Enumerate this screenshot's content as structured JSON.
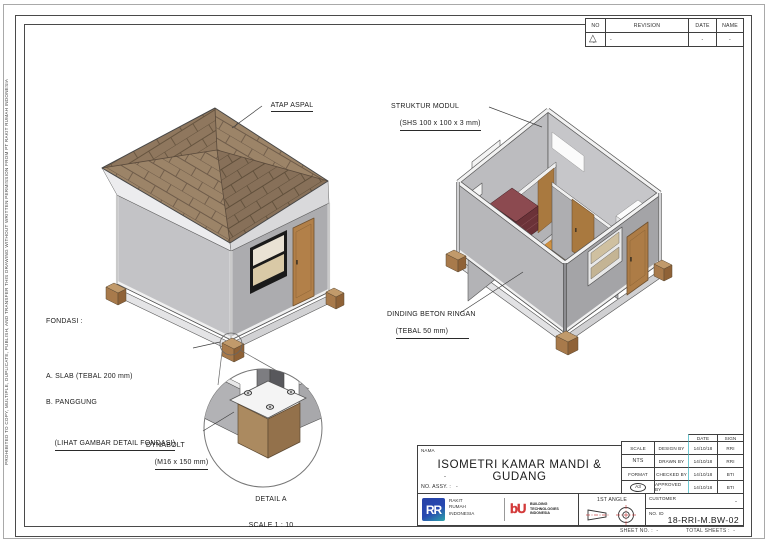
{
  "page": {
    "side_note": "PROHIBITED TO COPY, MULTIPLE, DUPLICATE, PUBLISH, AND TRANSFER THIS DRAWING WITHOUT WRITTEN PERMISSION FROM PT RAKIT RUMAH INDONESIA",
    "footer": {
      "sheet_no_label": "SHEET NO. :",
      "sheet_no_value": "-",
      "total_sheets_label": "TOTAL SHEETS :",
      "total_sheets_value": "-"
    }
  },
  "revision_table": {
    "headers": {
      "no": "NO",
      "revision": "REVISION",
      "date": "DATE",
      "name": "NAME"
    },
    "row": {
      "no": "-",
      "revision": "-",
      "date": "-",
      "name": "-"
    }
  },
  "annotations": {
    "atap": "ATAP ASPAL",
    "struktur_line1": "STRUKTUR MODUL",
    "struktur_line2": "(SHS 100 x 100 x 3 mm)",
    "fondasi_title": "FONDASI :",
    "fondasi_a": "A. SLAB (TEBAL 200 mm)",
    "fondasi_b": "B. PANGGUNG",
    "fondasi_note": "(LIHAT GAMBAR DETAIL FONDASI)",
    "dinding_line1": "DINDING BETON RINGAN",
    "dinding_line2": "(TEBAL 50 mm)",
    "dynabolt_line1": "DYNABOLT",
    "dynabolt_line2": "(M16 x 150 mm)",
    "detail_title": "DETAIL A",
    "detail_scale": "SCALE 1 : 10"
  },
  "title_block": {
    "nama_label": "NAMA",
    "title": "ISOMETRI KAMAR MANDI & GUDANG",
    "subtitle": "-",
    "no_assy_label": "NO. ASSY. :",
    "no_assy_value": "-",
    "scale_label": "SCALE",
    "scale_value": "NTS",
    "format_label": "FORMAT",
    "format_value": "A3",
    "date_header": "DATE",
    "sign_header": "SIGN",
    "sign_rows": [
      {
        "label": "DESIGN BY",
        "date": "14/10/18",
        "sign": "RRI"
      },
      {
        "label": "DRAWN BY",
        "date": "14/10/18",
        "sign": "RRI"
      },
      {
        "label": "CHECKED BY",
        "date": "14/10/18",
        "sign": "BTI"
      },
      {
        "label": "APPROVED BY",
        "date": "14/10/18",
        "sign": "BTI"
      }
    ],
    "logo_rri_text": "RR",
    "company1_lines": [
      "RAKIT",
      "RUMAH",
      "INDONESIA"
    ],
    "logo_bti_text": "bU",
    "company2_lines": [
      "BUILDING",
      "TECHNOLOGIES",
      "INDONESIA"
    ],
    "angle_label": "1ST ANGLE",
    "customer_label": "CUSTOMER",
    "customer_value": "-",
    "no_id_label": "NO. ID",
    "no_id_value": "18-RRI-M.BW-02"
  },
  "colors": {
    "roof_shingle": "#9c8468",
    "roof_line": "#6e5b49",
    "wall_light": "#c3c3c6",
    "wall_dark": "#a6a6a9",
    "door_wood": "#b28049",
    "floor_wood": "#d0913f",
    "brick_maroon": "#6b3238",
    "foundation_block": "#a87a4b",
    "logo_blue": "#2742a6",
    "logo_teal": "#2da5ab",
    "logo_red": "#d33a3a",
    "cad_cyan": "#6fc9d2",
    "line": "#4a4a4a"
  }
}
